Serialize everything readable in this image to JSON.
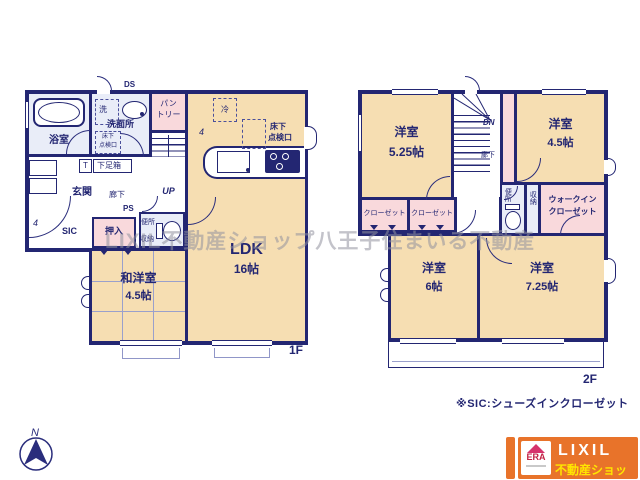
{
  "colors": {
    "wall_navy": "#232672",
    "room_beige": "#f6deb2",
    "room_pink": "#f9d9dc",
    "room_blue": "#e9edf8",
    "logo_orange": "#e8732a",
    "logo_yellow": "#ffe600",
    "era_red": "#cc2244",
    "watermark_gray": "#9191a0"
  },
  "watermark": "LIXIL不動産ショップ八王子住まいる不動産",
  "note": "※SIC:シューズインクローゼット",
  "compass": {
    "north": "N"
  },
  "logo": {
    "era": "ERA",
    "brand": "LIXIL",
    "brand_sub": "不動産ショップ"
  },
  "f1": {
    "floor_label": "1F",
    "bathroom": "浴室",
    "washroom": "洗面所",
    "washer": "洗",
    "ds": "DS",
    "pantry_l1": "パン",
    "pantry_l2": "トリー",
    "underfloor_l1": "床下",
    "underfloor_l2": "点検口",
    "fridge": "冷",
    "shoe_t": "T",
    "shoe_box": "下足箱",
    "entrance": "玄関",
    "hallway": "廊下",
    "ps": "PS",
    "up": "UP",
    "sic": "SIC",
    "dim_left": "4",
    "dim_top": "4",
    "closet": "押入",
    "toilet": "便所",
    "storage": "収納",
    "ldk": "LDK",
    "ldk_size": "16帖",
    "jw_room": "和洋室",
    "jw_size": "4.5帖"
  },
  "f2": {
    "floor_label": "2F",
    "dn": "DN",
    "hallway": "廊下",
    "room_nw": "洋室",
    "room_nw_size": "5.25帖",
    "room_ne": "洋室",
    "room_ne_size": "4.5帖",
    "closet_a": "クローゼット",
    "closet_b": "クローゼット",
    "toilet": "便所",
    "storage": "収納",
    "wic_l1": "ウォークイン",
    "wic_l2": "クローゼット",
    "room_sw": "洋室",
    "room_sw_size": "6帖",
    "room_se": "洋室",
    "room_se_size": "7.25帖"
  }
}
